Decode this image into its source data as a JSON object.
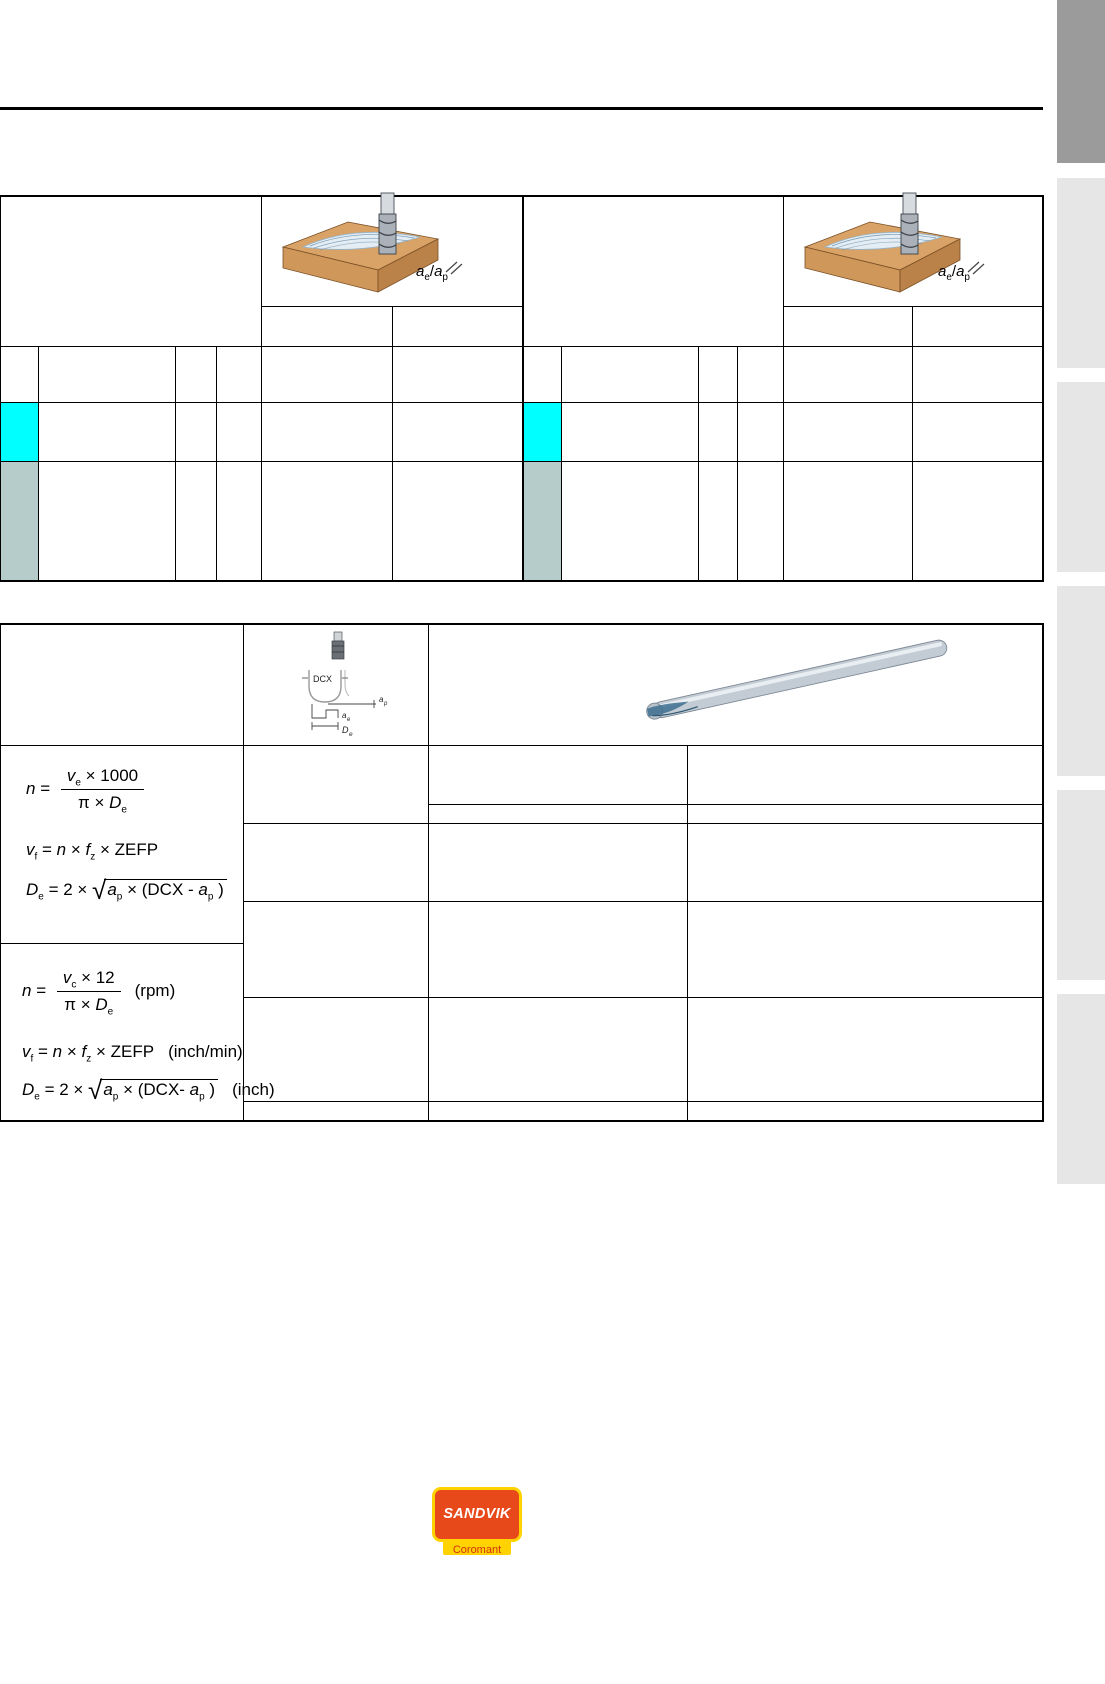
{
  "colors": {
    "row_highlight_cyan": "#00ffff",
    "row_highlight_teal": "#b5cccb",
    "sidebar_active_gray": "#9b9b9b",
    "sidebar_gray": "#e6e6e6",
    "logo_red": "#e8491a",
    "logo_yellow": "#ffd200"
  },
  "table1": {
    "ae_ap_label": {
      "a1": "a",
      "sub1": "e",
      "slash": "/",
      "a2": "a",
      "sub2": "p"
    }
  },
  "table2": {
    "dcx_diagram": {
      "dcx": "DCX",
      "ap": "a",
      "ap_sub": "p",
      "ae": "a",
      "ae_sub": "e",
      "de": "D",
      "de_sub": "e"
    },
    "formulas": {
      "metric": {
        "f1": {
          "lhs": "n",
          "eq": " = ",
          "num_v": "v",
          "num_v_sub": "e",
          "num_rest": " × 1000",
          "den_pre": "π × ",
          "den_d": "D",
          "den_sub": "e",
          "unit": ""
        },
        "f2": {
          "a": "v",
          "a_sub": "f",
          "b": " = ",
          "c": "n",
          "d": " × ",
          "e": "f",
          "e_sub": "z",
          "f": " × ZEFP",
          "unit": ""
        },
        "f3": {
          "a": "D",
          "a_sub": "e",
          "b": " = 2 × ",
          "rad": "√",
          "ra": "a",
          "ra_sub": "p",
          "mid": " × (DCX - ",
          "rb": "a",
          "rb_sub": "p",
          "end": " )",
          "unit": ""
        }
      },
      "inch": {
        "f1": {
          "lhs": "n",
          "eq": " = ",
          "num_v": "v",
          "num_v_sub": "c",
          "num_rest": " × 12",
          "den_pre": "π × ",
          "den_d": "D",
          "den_sub": "e",
          "unit": "(rpm)"
        },
        "f2": {
          "a": "v",
          "a_sub": "f",
          "b": " = ",
          "c": "n",
          "d": " × ",
          "e": "f",
          "e_sub": "z",
          "f": " × ZEFP",
          "unit": "(inch/min)"
        },
        "f3": {
          "a": "D",
          "a_sub": "e",
          "b": " = 2 × ",
          "rad": "√",
          "ra": "a",
          "ra_sub": "p",
          "mid": " × (DCX- ",
          "rb": "a",
          "rb_sub": "p",
          "end": " )",
          "unit": "(inch)"
        }
      }
    }
  },
  "logo": {
    "brand": "SANDVIK",
    "sub_brand": "Coromant"
  }
}
